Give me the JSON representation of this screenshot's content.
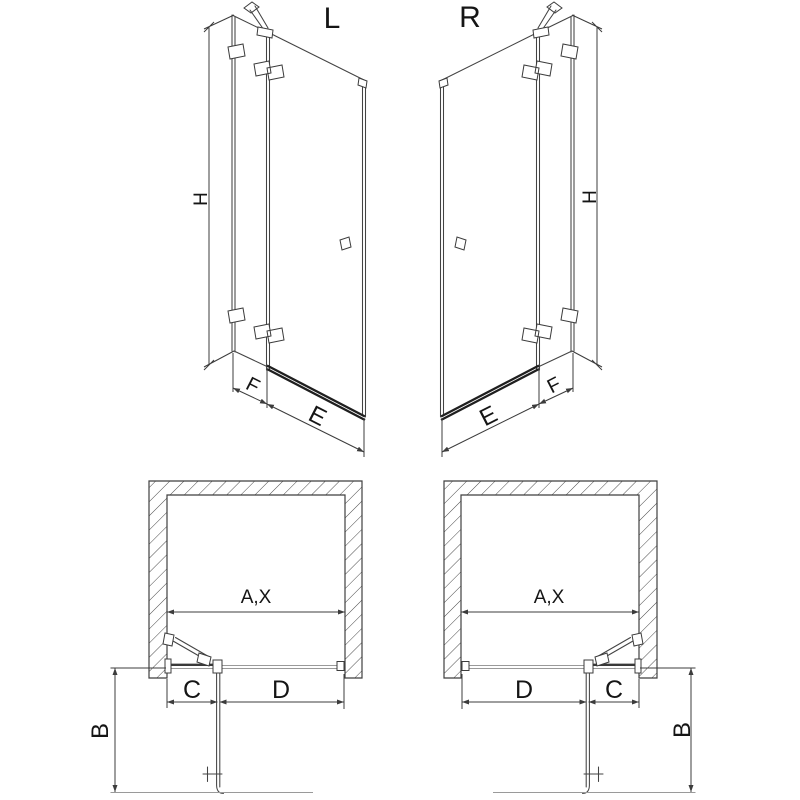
{
  "colors": {
    "background": "#ffffff",
    "line": "#434343",
    "text": "#151515",
    "hatch": "#4a4a4a"
  },
  "elevations": {
    "left": {
      "variant_label": "L",
      "height_dim": "H",
      "fixed_panel_dim": "F",
      "door_dim": "E"
    },
    "right": {
      "variant_label": "R",
      "height_dim": "H",
      "fixed_panel_dim": "F",
      "door_dim": "E"
    }
  },
  "plans": {
    "left": {
      "opening_width_dim": "A,X",
      "fixed_panel_dim": "C",
      "door_opening_dim": "D",
      "door_swing_dim": "B"
    },
    "right": {
      "opening_width_dim": "A,X",
      "fixed_panel_dim": "C",
      "door_opening_dim": "D",
      "door_swing_dim": "B"
    }
  }
}
